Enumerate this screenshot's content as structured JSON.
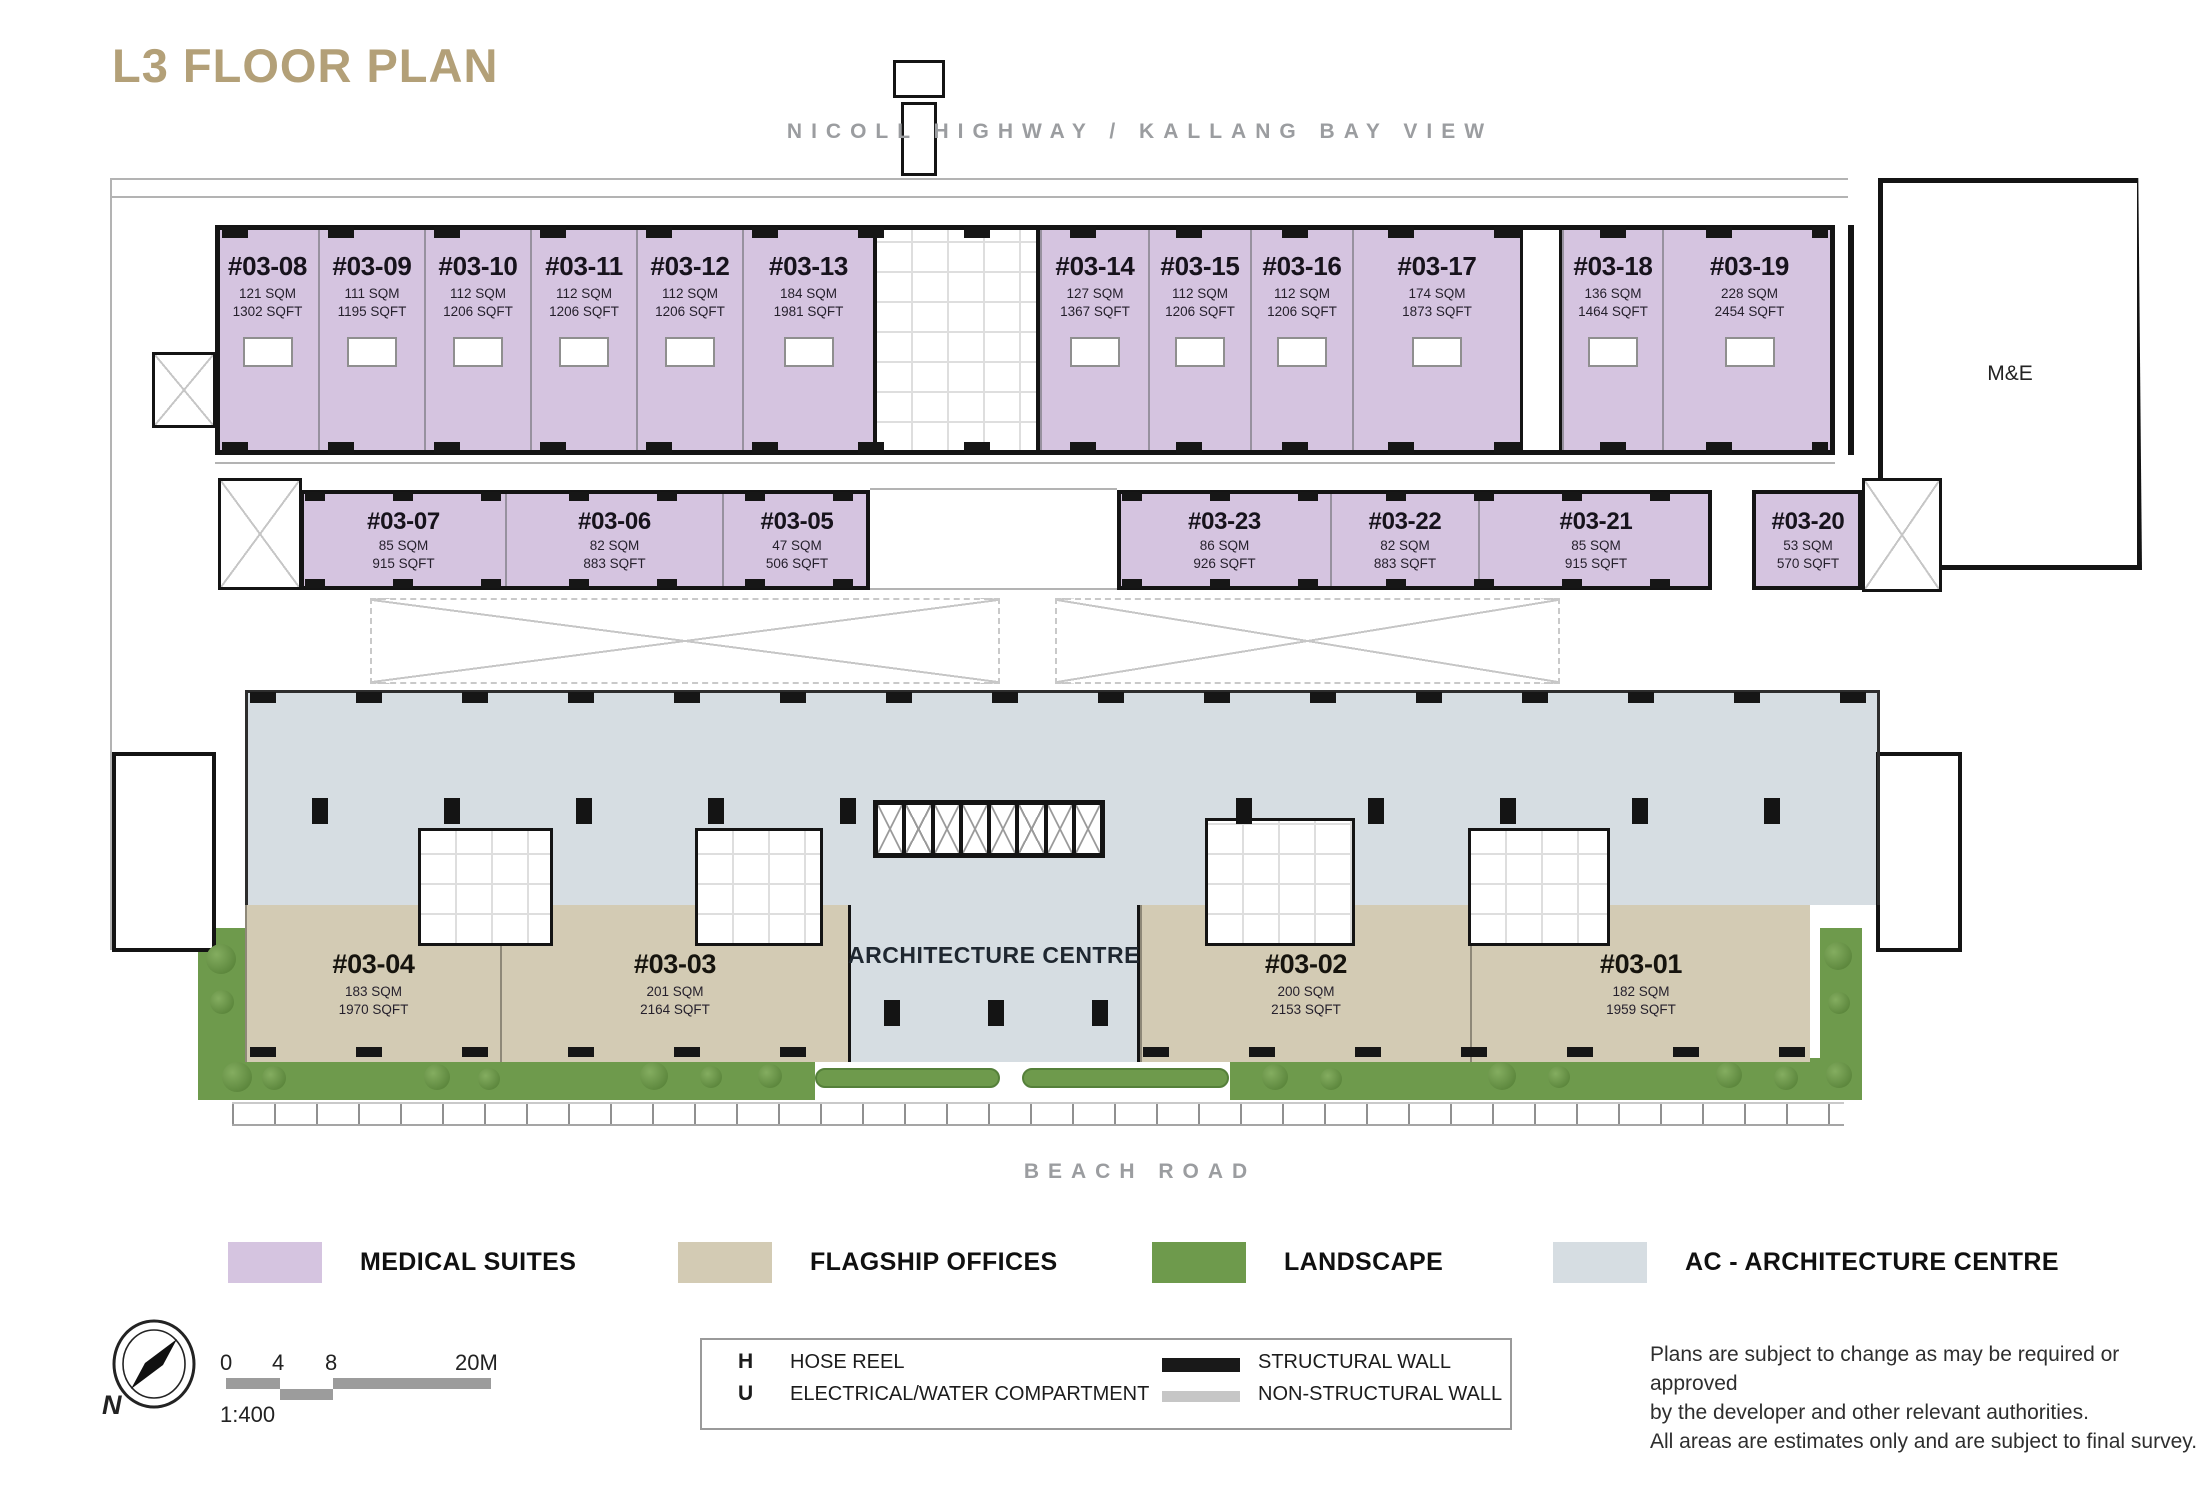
{
  "title": "L3 FLOOR PLAN",
  "roads": {
    "top": "NICOLL HIGHWAY / KALLANG BAY VIEW",
    "bottom": "BEACH ROAD"
  },
  "plan_labels": {
    "architecture_centre": "ARCHITECTURE CENTRE",
    "me_room": "M&E"
  },
  "units": [
    {
      "id": "#03-08",
      "sqm": "121 SQM",
      "sqft": "1302 SQFT",
      "category": "medical"
    },
    {
      "id": "#03-09",
      "sqm": "111 SQM",
      "sqft": "1195 SQFT",
      "category": "medical"
    },
    {
      "id": "#03-10",
      "sqm": "112 SQM",
      "sqft": "1206 SQFT",
      "category": "medical"
    },
    {
      "id": "#03-11",
      "sqm": "112 SQM",
      "sqft": "1206 SQFT",
      "category": "medical"
    },
    {
      "id": "#03-12",
      "sqm": "112 SQM",
      "sqft": "1206 SQFT",
      "category": "medical"
    },
    {
      "id": "#03-13",
      "sqm": "184 SQM",
      "sqft": "1981 SQFT",
      "category": "medical"
    },
    {
      "id": "#03-14",
      "sqm": "127 SQM",
      "sqft": "1367 SQFT",
      "category": "medical"
    },
    {
      "id": "#03-15",
      "sqm": "112 SQM",
      "sqft": "1206 SQFT",
      "category": "medical"
    },
    {
      "id": "#03-16",
      "sqm": "112 SQM",
      "sqft": "1206 SQFT",
      "category": "medical"
    },
    {
      "id": "#03-17",
      "sqm": "174 SQM",
      "sqft": "1873 SQFT",
      "category": "medical"
    },
    {
      "id": "#03-18",
      "sqm": "136 SQM",
      "sqft": "1464 SQFT",
      "category": "medical"
    },
    {
      "id": "#03-19",
      "sqm": "228 SQM",
      "sqft": "2454 SQFT",
      "category": "medical"
    },
    {
      "id": "#03-07",
      "sqm": "85 SQM",
      "sqft": "915 SQFT",
      "category": "medical"
    },
    {
      "id": "#03-06",
      "sqm": "82 SQM",
      "sqft": "883 SQFT",
      "category": "medical"
    },
    {
      "id": "#03-05",
      "sqm": "47 SQM",
      "sqft": "506 SQFT",
      "category": "medical"
    },
    {
      "id": "#03-23",
      "sqm": "86 SQM",
      "sqft": "926 SQFT",
      "category": "medical"
    },
    {
      "id": "#03-22",
      "sqm": "82 SQM",
      "sqft": "883 SQFT",
      "category": "medical"
    },
    {
      "id": "#03-21",
      "sqm": "85 SQM",
      "sqft": "915 SQFT",
      "category": "medical"
    },
    {
      "id": "#03-20",
      "sqm": "53 SQM",
      "sqft": "570 SQFT",
      "category": "medical"
    },
    {
      "id": "#03-04",
      "sqm": "183 SQM",
      "sqft": "1970 SQFT",
      "category": "office"
    },
    {
      "id": "#03-03",
      "sqm": "201 SQM",
      "sqft": "2164 SQFT",
      "category": "office"
    },
    {
      "id": "#03-02",
      "sqm": "200 SQM",
      "sqft": "2153 SQFT",
      "category": "office"
    },
    {
      "id": "#03-01",
      "sqm": "182 SQM",
      "sqft": "1959 SQFT",
      "category": "office"
    }
  ],
  "legend": [
    {
      "label": "MEDICAL SUITES",
      "color": "#d5c4e0"
    },
    {
      "label": "FLAGSHIP OFFICES",
      "color": "#d3cbb4"
    },
    {
      "label": "LANDSCAPE",
      "color": "#6e9a4c"
    },
    {
      "label": "AC - ARCHITECTURE CENTRE",
      "color": "#d6dde2"
    }
  ],
  "symbol_key": {
    "entries": [
      {
        "symbol": "H",
        "label": "HOSE REEL"
      },
      {
        "symbol": "U",
        "label": "ELECTRICAL/WATER COMPARTMENT"
      }
    ],
    "walls": [
      {
        "label": "STRUCTURAL WALL",
        "color": "#191919"
      },
      {
        "label": "NON-STRUCTURAL WALL",
        "color": "#c6c6c6"
      }
    ]
  },
  "scale_bar": {
    "ticks": [
      "0",
      "4",
      "8",
      "20M"
    ],
    "ratio": "1:400"
  },
  "compass": {
    "label": "N"
  },
  "disclaimer": [
    "Plans are subject to change as may be required or approved",
    "by the developer and other relevant authorities.",
    "All areas are estimates only and are subject to final survey."
  ],
  "colors": {
    "title": "#b3a078",
    "road_label": "#9b9da0",
    "structural_wall": "#141414"
  }
}
